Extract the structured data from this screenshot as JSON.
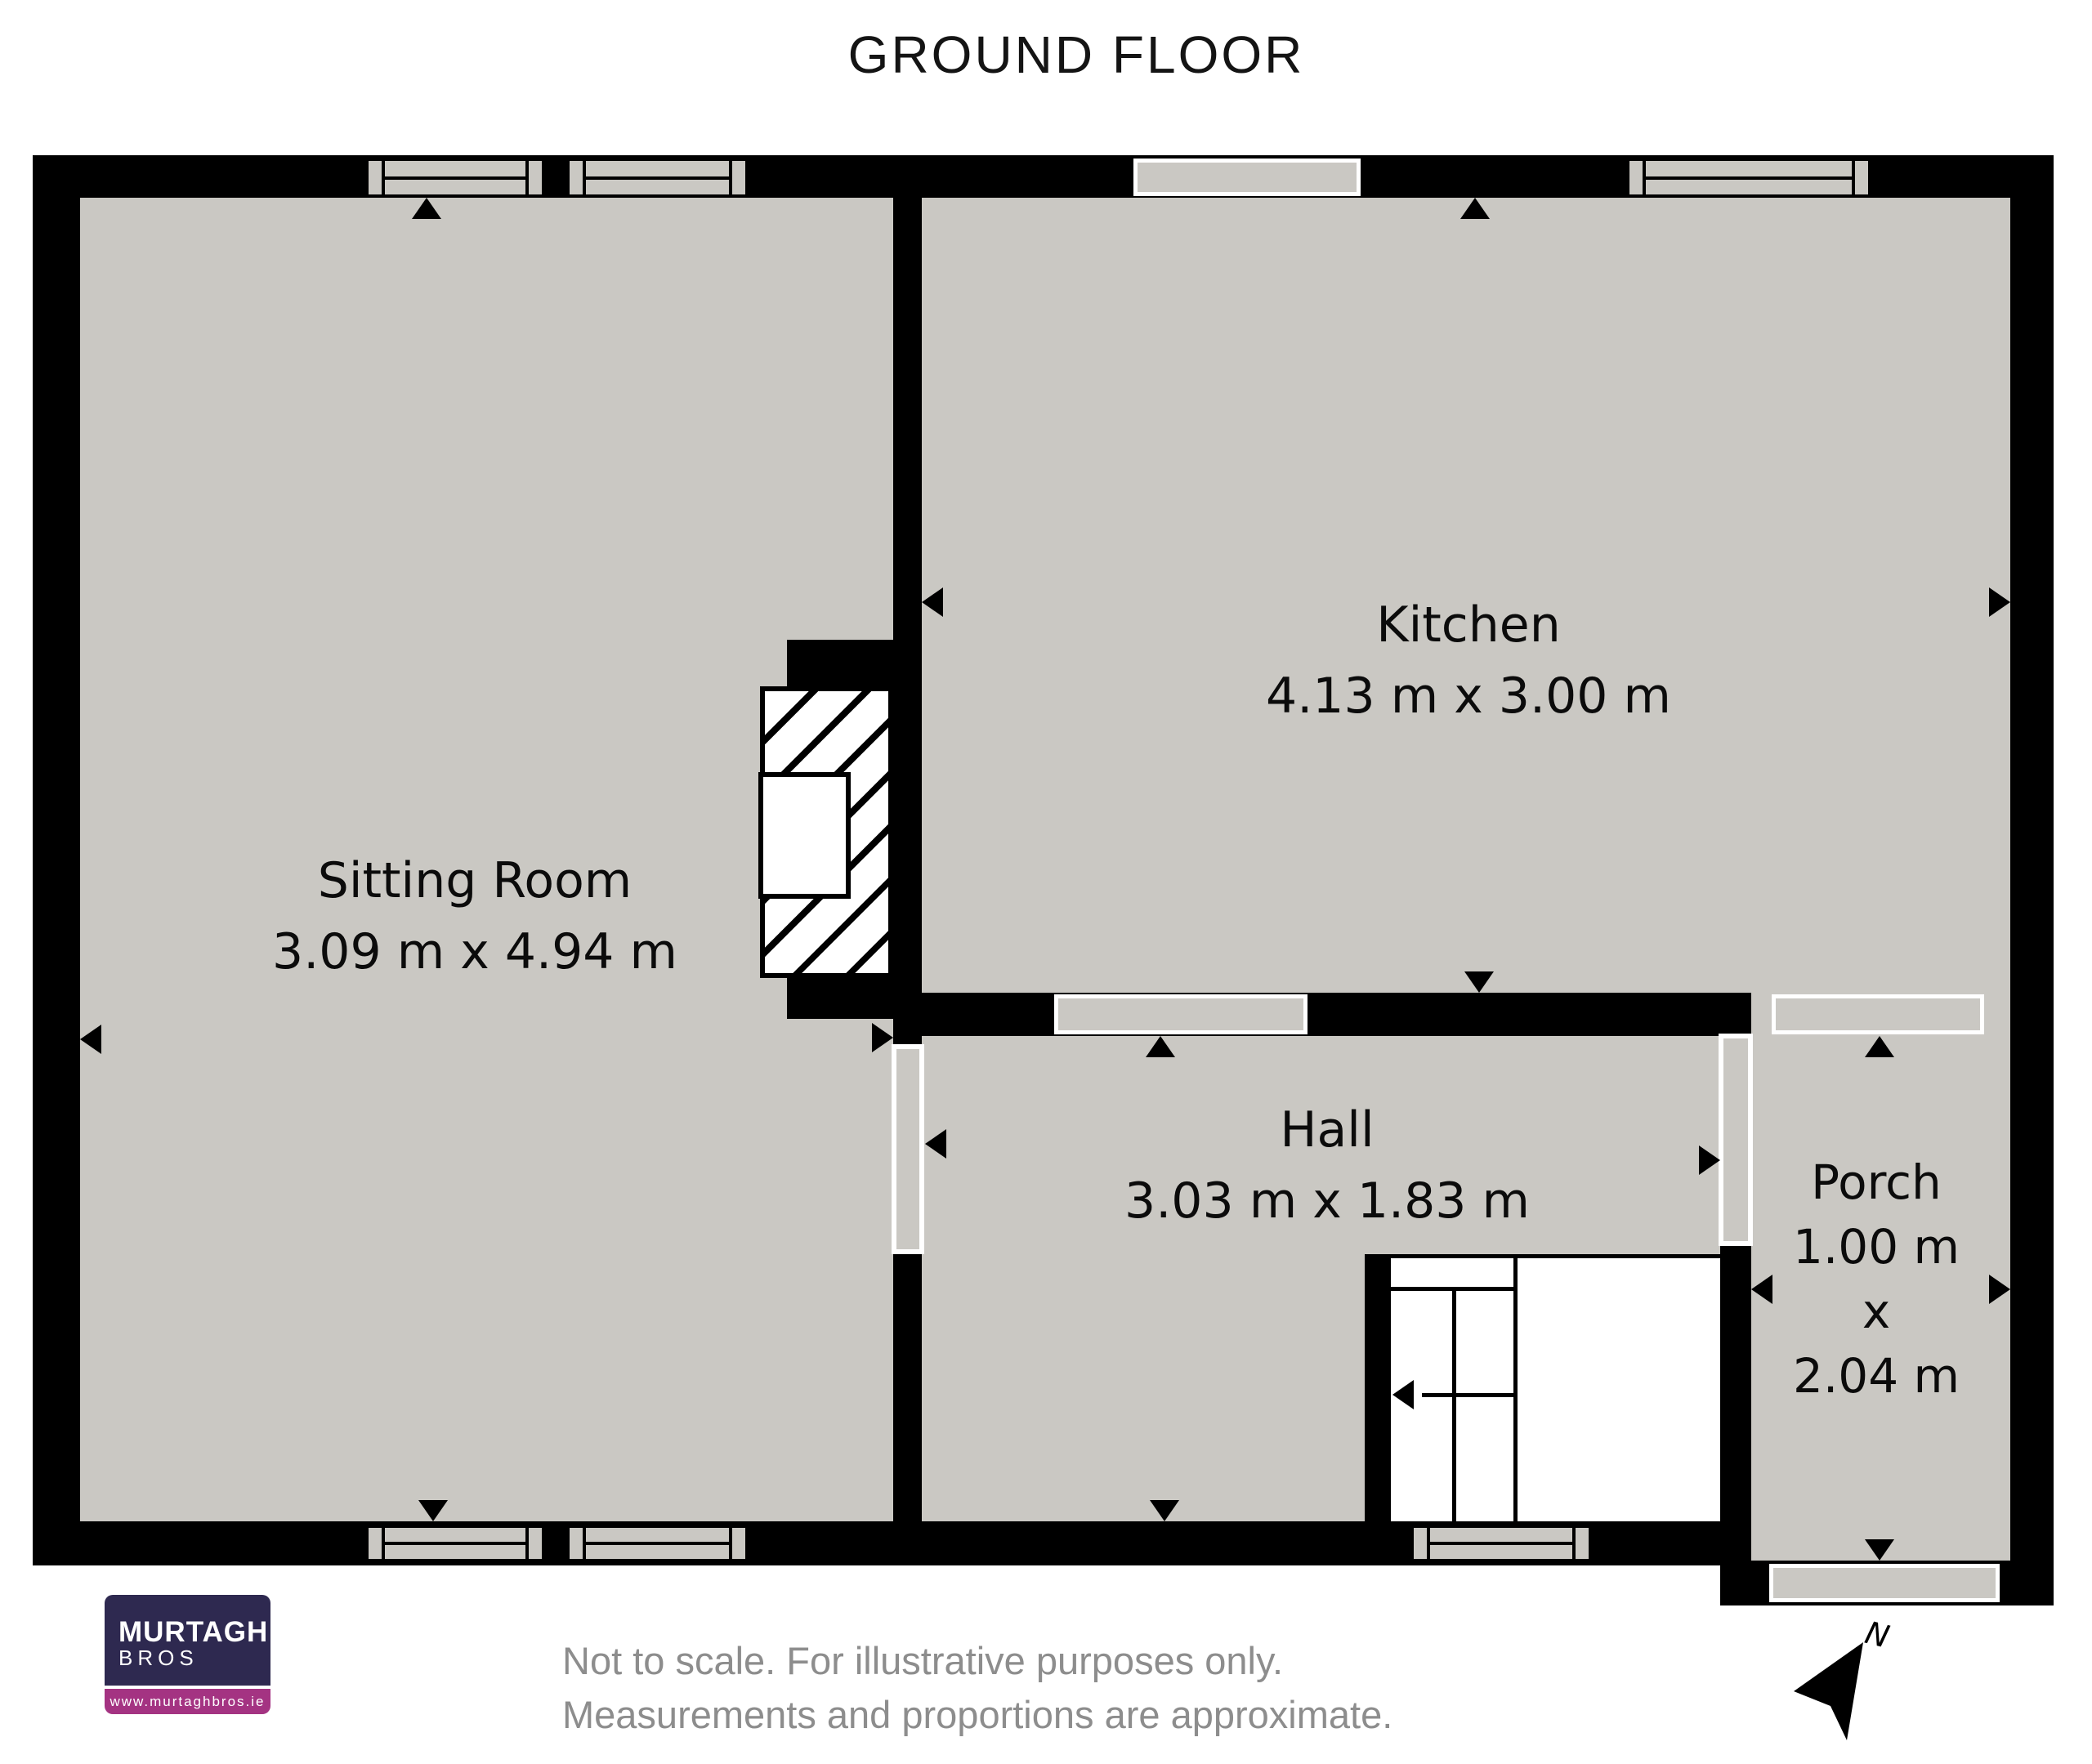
{
  "title": "GROUND FLOOR",
  "rooms": {
    "sitting": {
      "name": "Sitting Room",
      "dims": "3.09 m x 4.94 m"
    },
    "kitchen": {
      "name": "Kitchen",
      "dims": "4.13 m x 3.00 m"
    },
    "hall": {
      "name": "Hall",
      "dims": "3.03 m x 1.83 m"
    },
    "porch": {
      "name": "Porch",
      "dim1": "1.00 m",
      "dim2": "x",
      "dim3": "2.04 m"
    }
  },
  "compass": {
    "label": "N"
  },
  "footer": {
    "disclaimer_line1": "Not to scale. For illustrative purposes only.",
    "disclaimer_line2": "Measurements and proportions are approximate."
  },
  "logo": {
    "name_top": "MURTAGH",
    "name_bottom": "BROS",
    "website": "www.murtaghbros.ie"
  },
  "colors": {
    "room_fill": "#cac8c3",
    "wall": "#000000",
    "logo_navy": "#2e2950",
    "logo_magenta": "#a43382",
    "disclaimer_gray": "#8d8d8d"
  }
}
